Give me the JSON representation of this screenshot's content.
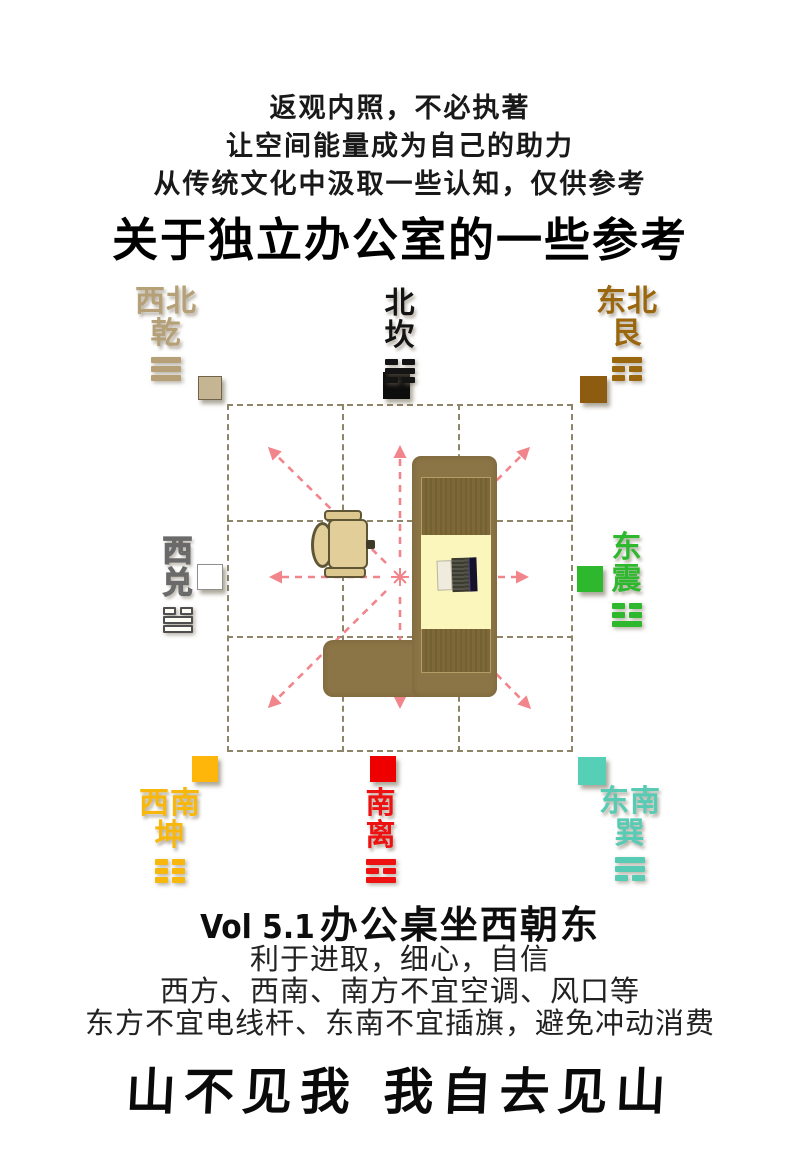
{
  "header": {
    "line1": "返观内照，不必执著",
    "line2": "让空间能量成为自己的助力",
    "line3": "从传统文化中汲取一些认知，仅供参考",
    "title": "关于独立办公室的一些参考"
  },
  "colors": {
    "arrow_pink": "#f2858b",
    "grid_line": "#8e8468",
    "desk_brown": "#8b7446",
    "desk_panel_brown": "#7c6838",
    "desk_pad_yellow": "#fbf6bc",
    "chair_tan": "#e2ce99",
    "chair_outline": "#5f5636"
  },
  "icons": {
    "desk": "l-shaped-desk-top-view",
    "chair": "office-chair-top-view",
    "laptop": "laptop-top-view",
    "arrows": "eight-direction-dashed-arrows",
    "grid": "nine-palace-dashed-grid"
  },
  "compass": {
    "directions": [
      {
        "id": "northwest-qian",
        "chars": [
          "西北",
          "乾"
        ],
        "trigram": [
          1,
          1,
          1
        ],
        "color": "#b5a077",
        "label": {
          "x": 166,
          "y": 286
        },
        "square": {
          "x": 198,
          "y": 376,
          "size": 24,
          "color": "#c5b593",
          "border": "#6f6449"
        }
      },
      {
        "id": "north-kan",
        "chars": [
          "北",
          "坎"
        ],
        "trigram": [
          0,
          1,
          0
        ],
        "color": "#141414",
        "label": {
          "x": 400,
          "y": 288
        },
        "square": {
          "x": 383,
          "y": 372,
          "size": 27,
          "color": "#0d0d0d",
          "border": ""
        }
      },
      {
        "id": "northeast-gen",
        "chars": [
          "东北",
          "艮"
        ],
        "trigram": [
          1,
          0,
          0
        ],
        "color": "#9a660e",
        "label": {
          "x": 627,
          "y": 286
        },
        "square": {
          "x": 580,
          "y": 376,
          "size": 27,
          "color": "#8d5c10",
          "border": ""
        }
      },
      {
        "id": "west-dui",
        "chars": [
          "西",
          "兑"
        ],
        "trigram": [
          0,
          1,
          1
        ],
        "color": "#ffffff",
        "outlined": true,
        "label": {
          "x": 178,
          "y": 536
        },
        "square": {
          "x": 197,
          "y": 564,
          "size": 26,
          "color": "#ffffff",
          "border": "#8f8f8f"
        }
      },
      {
        "id": "east-zhen",
        "chars": [
          "东",
          "震"
        ],
        "trigram": [
          0,
          0,
          1
        ],
        "color": "#2eb82e",
        "label": {
          "x": 627,
          "y": 532
        },
        "square": {
          "x": 577,
          "y": 566,
          "size": 26,
          "color": "#2eb82e",
          "border": ""
        }
      },
      {
        "id": "southwest-kun",
        "chars": [
          "西南",
          "坤"
        ],
        "trigram": [
          0,
          0,
          0
        ],
        "color": "#f7b70c",
        "label": {
          "x": 170,
          "y": 788
        },
        "square": {
          "x": 192,
          "y": 756,
          "size": 26,
          "color": "#ffb60a",
          "border": ""
        }
      },
      {
        "id": "south-li",
        "chars": [
          "南",
          "离"
        ],
        "trigram": [
          1,
          0,
          1
        ],
        "color": "#ee1111",
        "label": {
          "x": 381,
          "y": 788
        },
        "square": {
          "x": 370,
          "y": 756,
          "size": 26,
          "color": "#ee0000",
          "border": ""
        }
      },
      {
        "id": "southeast-xun",
        "chars": [
          "东南",
          "巽"
        ],
        "trigram": [
          1,
          1,
          0
        ],
        "color": "#58cbb4",
        "label": {
          "x": 630,
          "y": 786
        },
        "square": {
          "x": 578,
          "y": 757,
          "size": 28,
          "color": "#55cfb5",
          "border": ""
        }
      }
    ]
  },
  "footer": {
    "vol_label": "Vol 5.1",
    "vol_title": "办公桌坐西朝东",
    "line1": "利于进取，细心，自信",
    "line2": "西方、西南、南方不宜空调、风口等",
    "line3": "东方不宜电线杆、东南不宜插旗，避免冲动消费",
    "calligraphy": "山不见我 我自去见山"
  }
}
